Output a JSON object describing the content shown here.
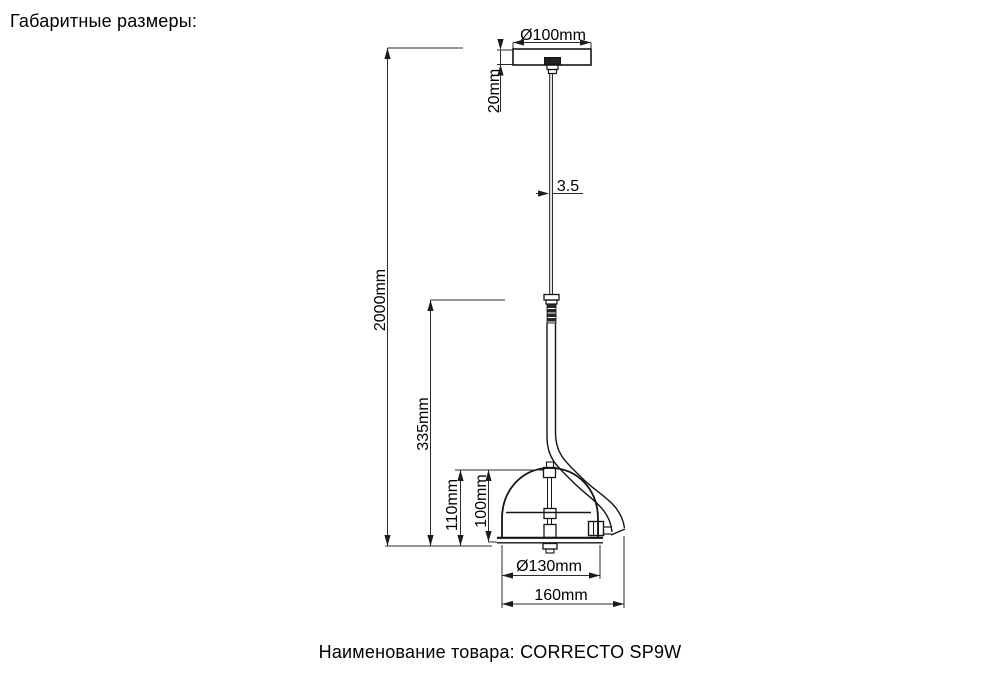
{
  "page": {
    "title": "Габаритные размеры:",
    "caption_label": "Наименование товара:",
    "product_name": "CORRECTO SP9W"
  },
  "drawing": {
    "labels": {
      "canopy_diameter": "Ø100mm",
      "canopy_height": "20mm",
      "cord_diameter": "3.5",
      "suspension_height": "2000mm",
      "stem_height": "335mm",
      "shade_outer_height": "110mm",
      "shade_inner_height": "100mm",
      "shade_diameter": "Ø130mm",
      "overall_width": "160mm"
    },
    "colors": {
      "line": "#151515",
      "dimension": "#2b2b2b",
      "background": "#ffffff"
    }
  }
}
